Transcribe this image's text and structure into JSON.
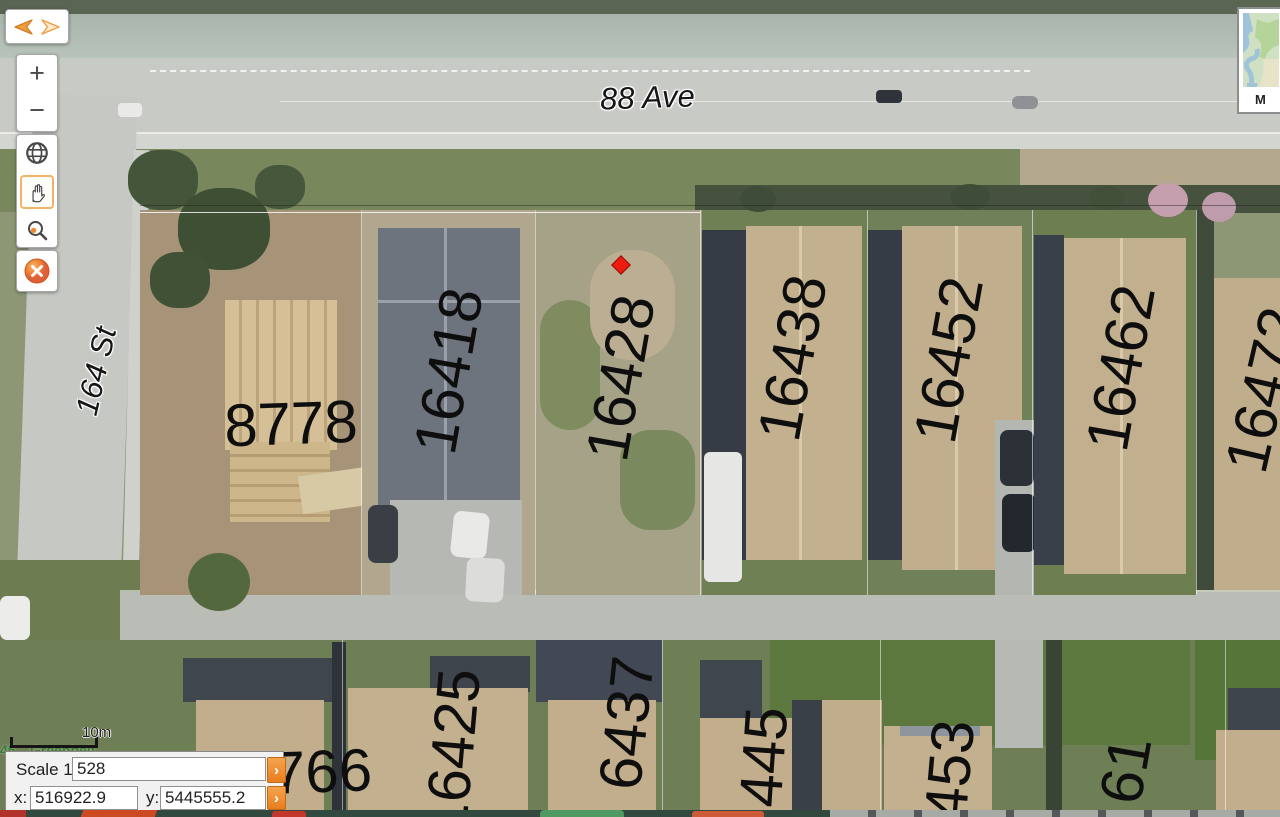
{
  "toolbar": {
    "nav": {
      "back": "back-arrow-icon",
      "forward": "forward-arrow-icon"
    },
    "zoom_in_label": "+",
    "zoom_out_label": "−",
    "tools": [
      "globe-icon",
      "pan-hand-icon",
      "zoom-select-icon"
    ],
    "active_tool": "pan-hand-icon",
    "close_icon": "close-x-icon",
    "accent_color": "#ef9d43"
  },
  "minimap": {
    "label": "M"
  },
  "status_panel": {
    "scale_label": "Scale 1:",
    "scale_value": "528",
    "x_label": "x:",
    "x_value": "516922.9",
    "y_label": "y:",
    "y_value": "5445555.2",
    "go_button": "›"
  },
  "map": {
    "street_labels": [
      "88 Ave",
      "164 St"
    ],
    "parcels": [
      "8778",
      "16418",
      "16428",
      "16438",
      "16452",
      "16462",
      "16472",
      "766",
      "16425",
      "6437",
      "445",
      "453",
      "61"
    ],
    "greenbelt_label": "Greenbelt",
    "greenbelt_fragment": "45",
    "scale_bar_label": "10m",
    "marker_color": "#ee1c0e"
  }
}
